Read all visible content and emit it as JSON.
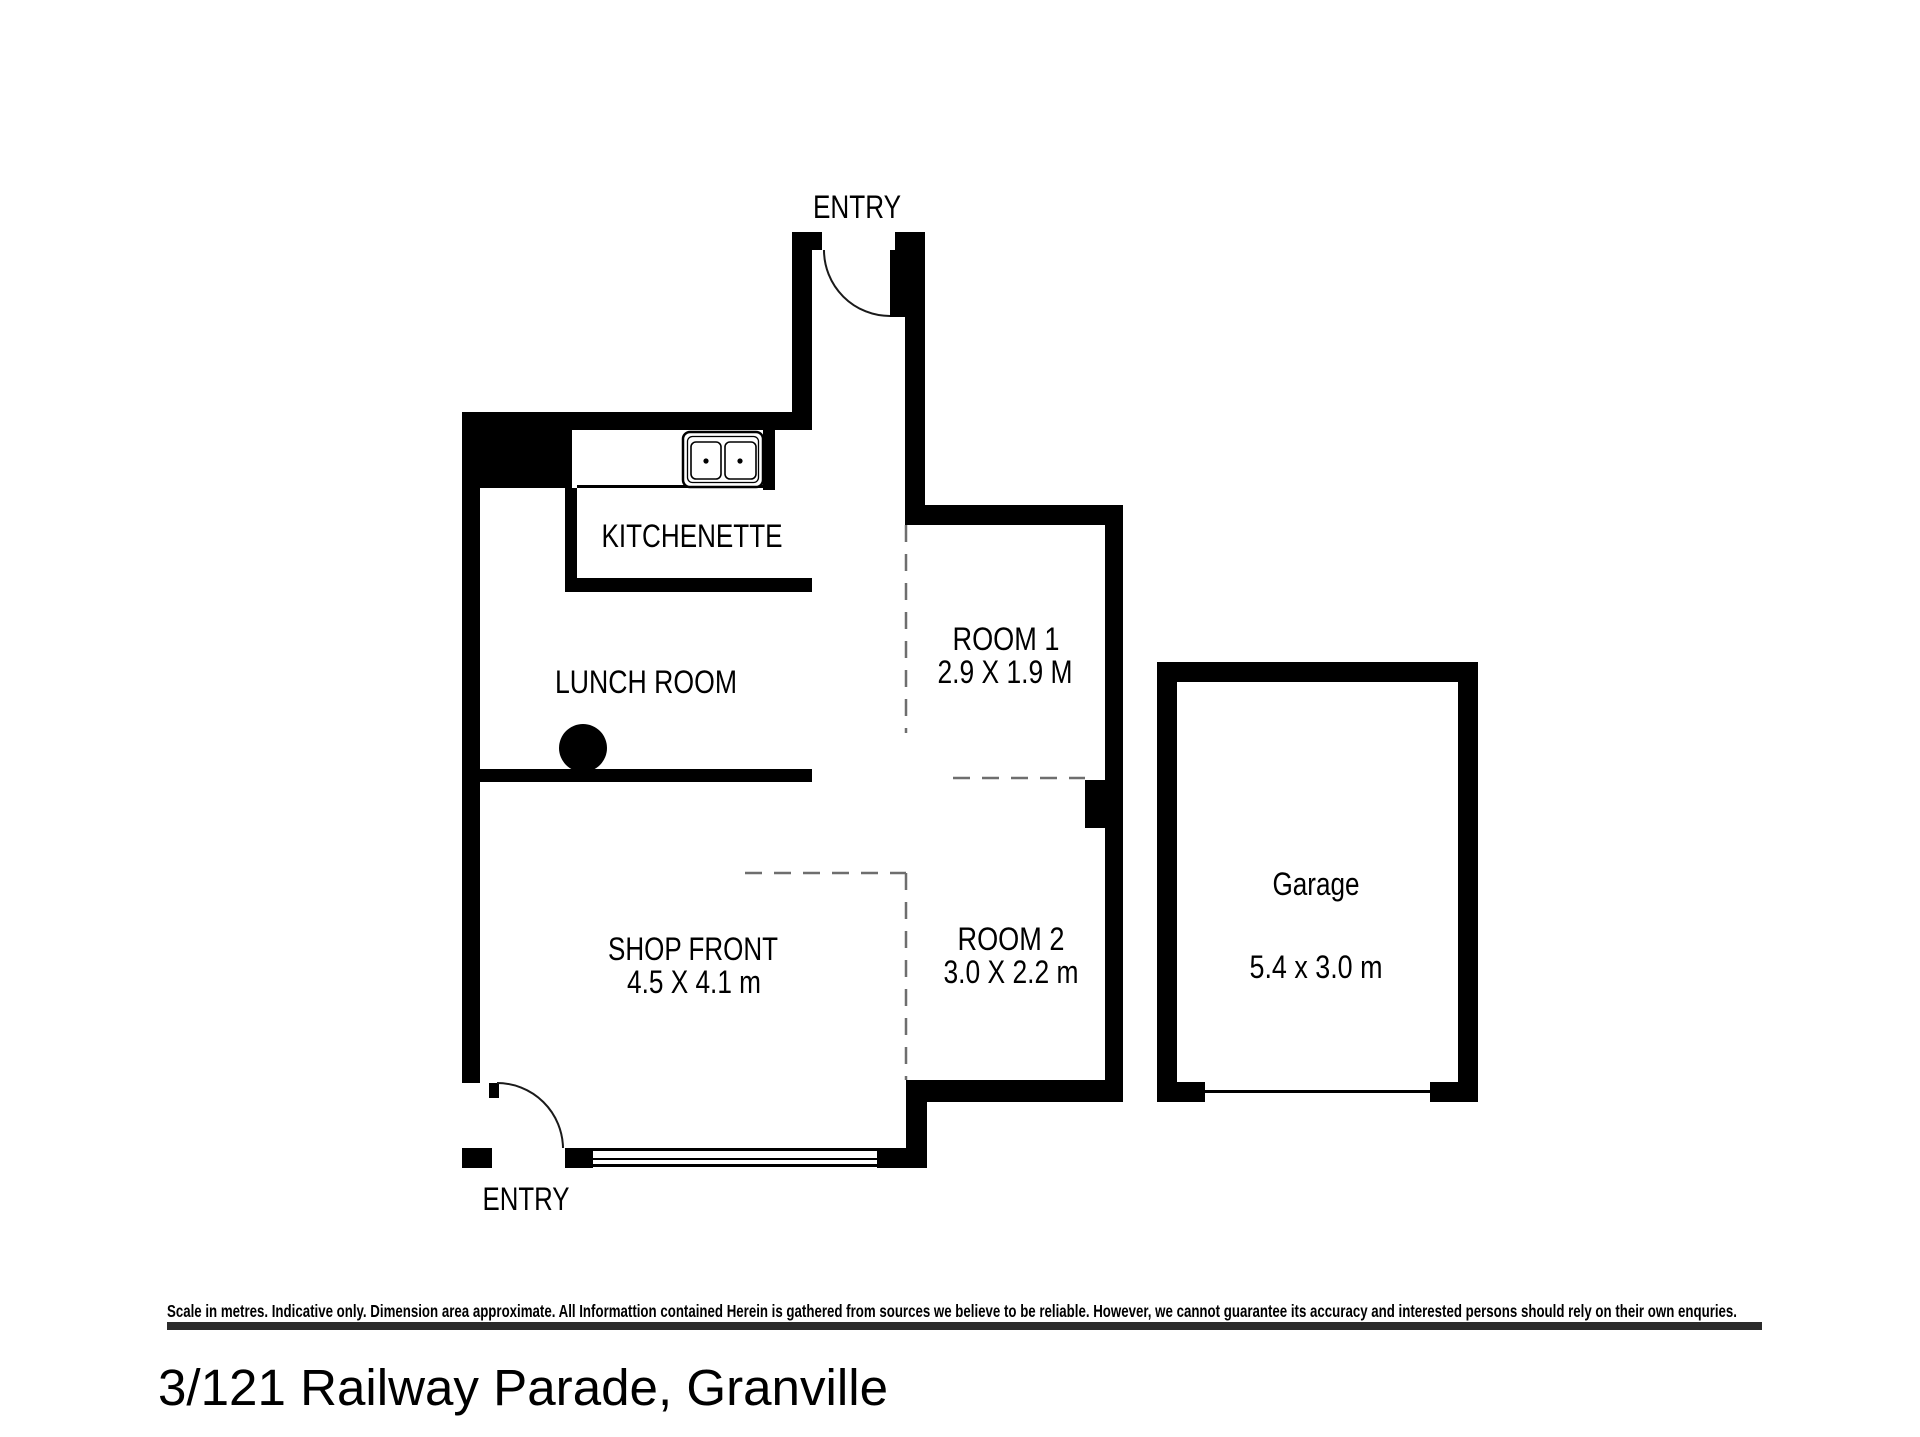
{
  "page": {
    "title": "3/121 Railway Parade, Granville",
    "disclaimer": "Scale in metres. Indicative only. Dimension area approximate. All Informattion contained Herein is gathered from sources we believe to be reliable. However, we cannot guarantee its accuracy and interested persons should rely on their own enquries."
  },
  "floorplan": {
    "labels": {
      "entry_top": "ENTRY",
      "entry_bottom": "ENTRY",
      "kitchenette": "KITCHENETTE",
      "lunch_room": "LUNCH ROOM",
      "room1_name": "ROOM 1",
      "room1_dims": "2.9 X 1.9 M",
      "shop_front_name": "SHOP FRONT",
      "shop_front_dims": "4.5 X 4.1 m",
      "room2_name": "ROOM 2",
      "room2_dims": "3.0 X 2.2 m",
      "garage_name": "Garage",
      "garage_dims": "5.4 x 3.0 m"
    },
    "rooms": [
      {
        "name": "KITCHENETTE",
        "dimensions": ""
      },
      {
        "name": "LUNCH ROOM",
        "dimensions": ""
      },
      {
        "name": "ROOM 1",
        "dimensions": "2.9 X 1.9 M"
      },
      {
        "name": "SHOP FRONT",
        "dimensions": "4.5 X 4.1 m"
      },
      {
        "name": "ROOM 2",
        "dimensions": "3.0 X 2.2 m"
      },
      {
        "name": "Garage",
        "dimensions": "5.4 x 3.0 m"
      }
    ],
    "colors": {
      "wall": "#000000",
      "dashed_partition": "#6e6e6e",
      "background": "#ffffff",
      "rule_bar": "#2b2b2b"
    }
  }
}
